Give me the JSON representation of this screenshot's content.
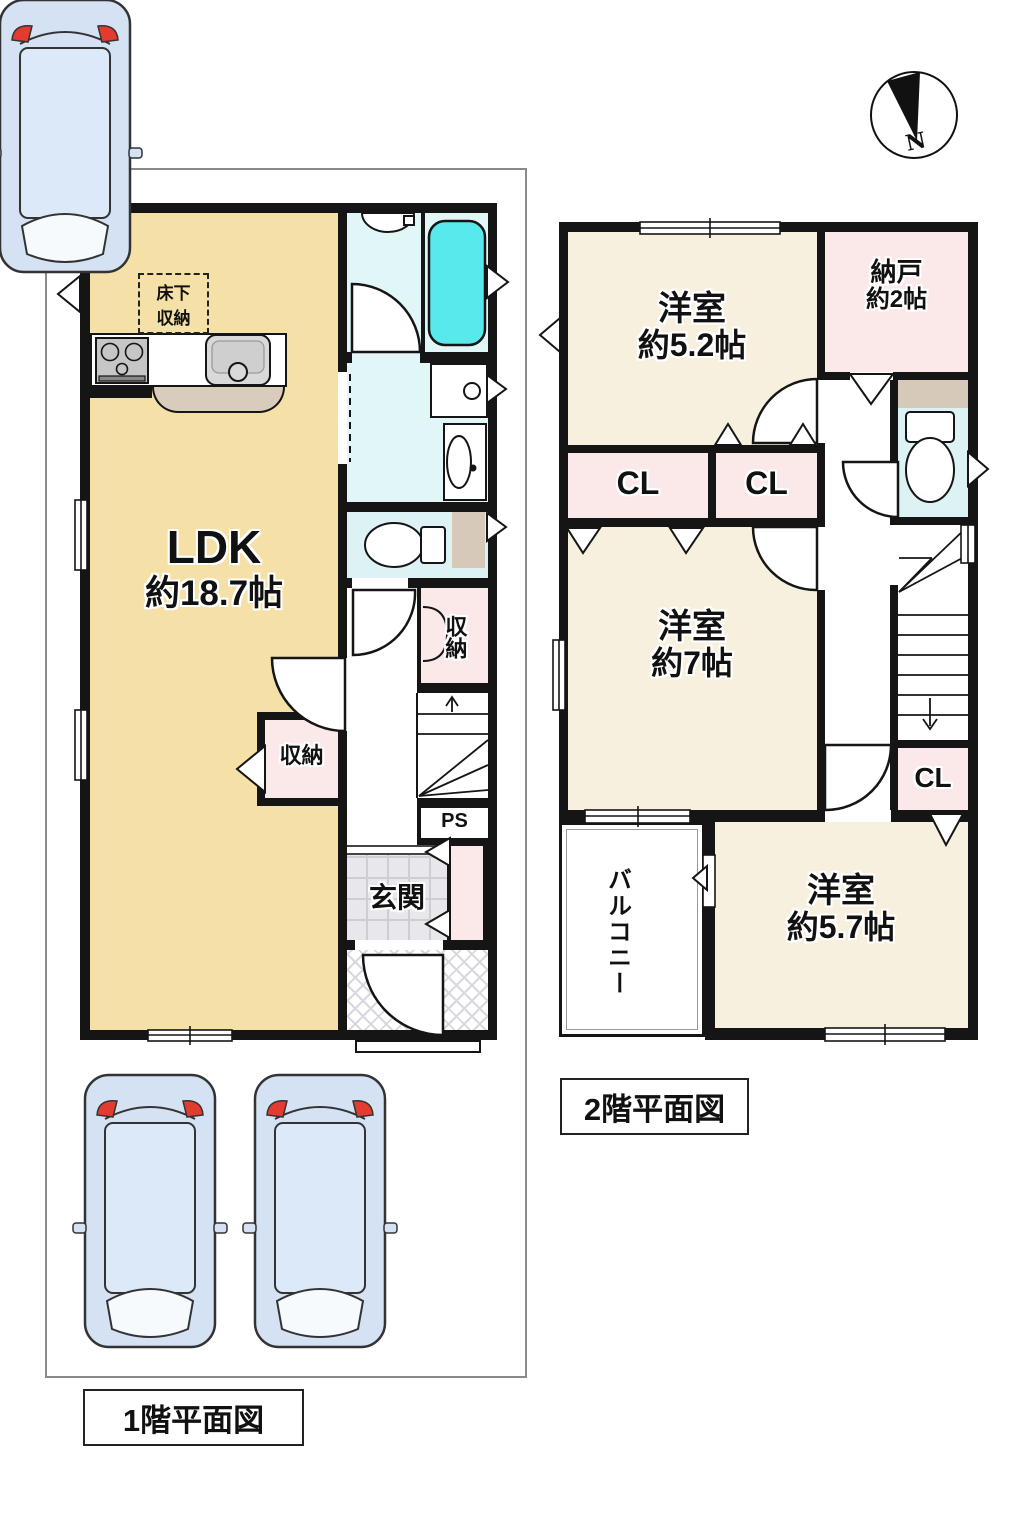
{
  "page": {
    "floor1_title": "1階平面図",
    "floor2_title": "2階平面図"
  },
  "compass": {
    "north": "N"
  },
  "floor1": {
    "ldk_name": "LDK",
    "ldk_size": "約18.7帖",
    "underfloor_line1": "床下",
    "underfloor_line2": "収納",
    "storage_hall": "収納",
    "storage_ldk": "収納",
    "ps": "PS",
    "entrance": "玄関"
  },
  "floor2": {
    "bedroom1_name": "洋室",
    "bedroom1_size": "約5.2帖",
    "storeroom_name": "納戸",
    "storeroom_size": "約2帖",
    "closet1": "CL",
    "closet2": "CL",
    "closet3": "CL",
    "bedroom2_name": "洋室",
    "bedroom2_size": "約7帖",
    "bedroom3_name": "洋室",
    "bedroom3_size": "約5.7帖",
    "balcony": "バルコニー"
  },
  "colors": {
    "ldk": "#F5E1A8",
    "bedroom": "#F8F0DE",
    "pink": "#FBE9E9",
    "cyan_room": "#E0F6F7",
    "tub": "#57E9EC",
    "tan": "#D6C9B9",
    "entrance_tile": "#E8E8EC",
    "car": "#D4E2F3",
    "wall": "#151515"
  }
}
